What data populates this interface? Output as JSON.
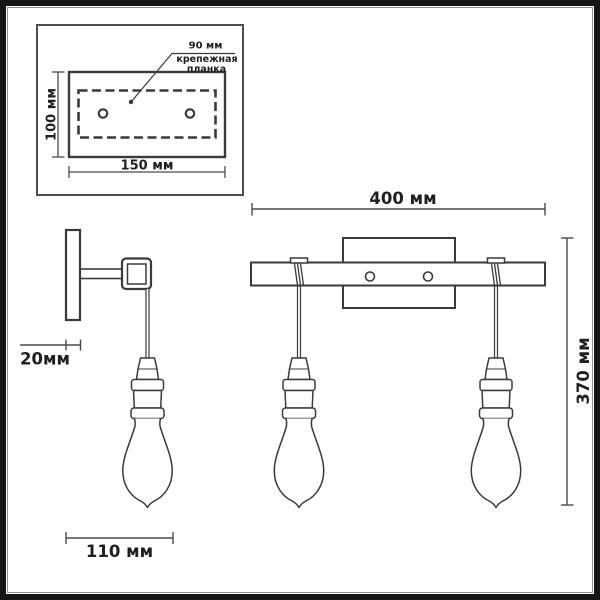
{
  "inset": {
    "hole_spacing_label": "90 мм",
    "plate_name_line1": "крепежная",
    "plate_name_line2": "планка",
    "height_label": "100 мм",
    "width_label": "150 мм"
  },
  "side_view": {
    "depth_label": "20мм",
    "bulb_width_label": "110 мм"
  },
  "front_view": {
    "width_label": "400 мм",
    "height_label": "370 мм"
  },
  "colors": {
    "line": "#3a3a3a",
    "dim_line": "#4a4a4a",
    "inset_border": "#4d4d4d",
    "text": "#1f1f1f",
    "frame": "#151515",
    "frame_inner": "#909090",
    "background": "#ffffff"
  }
}
